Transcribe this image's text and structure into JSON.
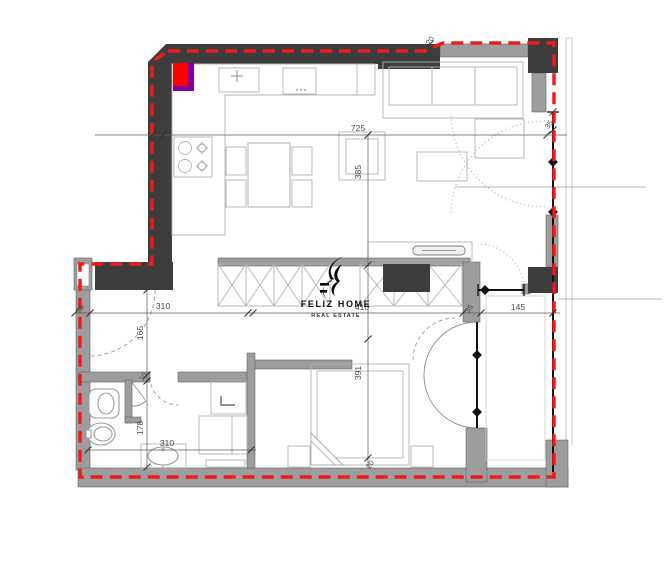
{
  "watermark": {
    "brand": "FELIZ HOME",
    "tagline": "REAL ESTATE"
  },
  "dims": {
    "top_width": "725",
    "living_depth": "385",
    "bedroom_depth": "391",
    "hall_width": "310",
    "bath_width": "310",
    "inner_width": "410",
    "balcony_width": "145",
    "hall_depth": "165",
    "bath_depth": "178",
    "seg_10": "10",
    "seg_20_top": "20",
    "seg_20_step": "20",
    "seg_20_bottom": "20",
    "seg_25": "25",
    "seg_35_window": "35",
    "seg_35_hall": "35"
  },
  "colors": {
    "boundary_red": "#ee1b1b",
    "wall_dark": "#3d3d3d",
    "wall_gray": "#9d9d9d",
    "appliance_red": "#fe0000",
    "appliance_purple": "#7d00a0",
    "window_black": "#111111"
  }
}
